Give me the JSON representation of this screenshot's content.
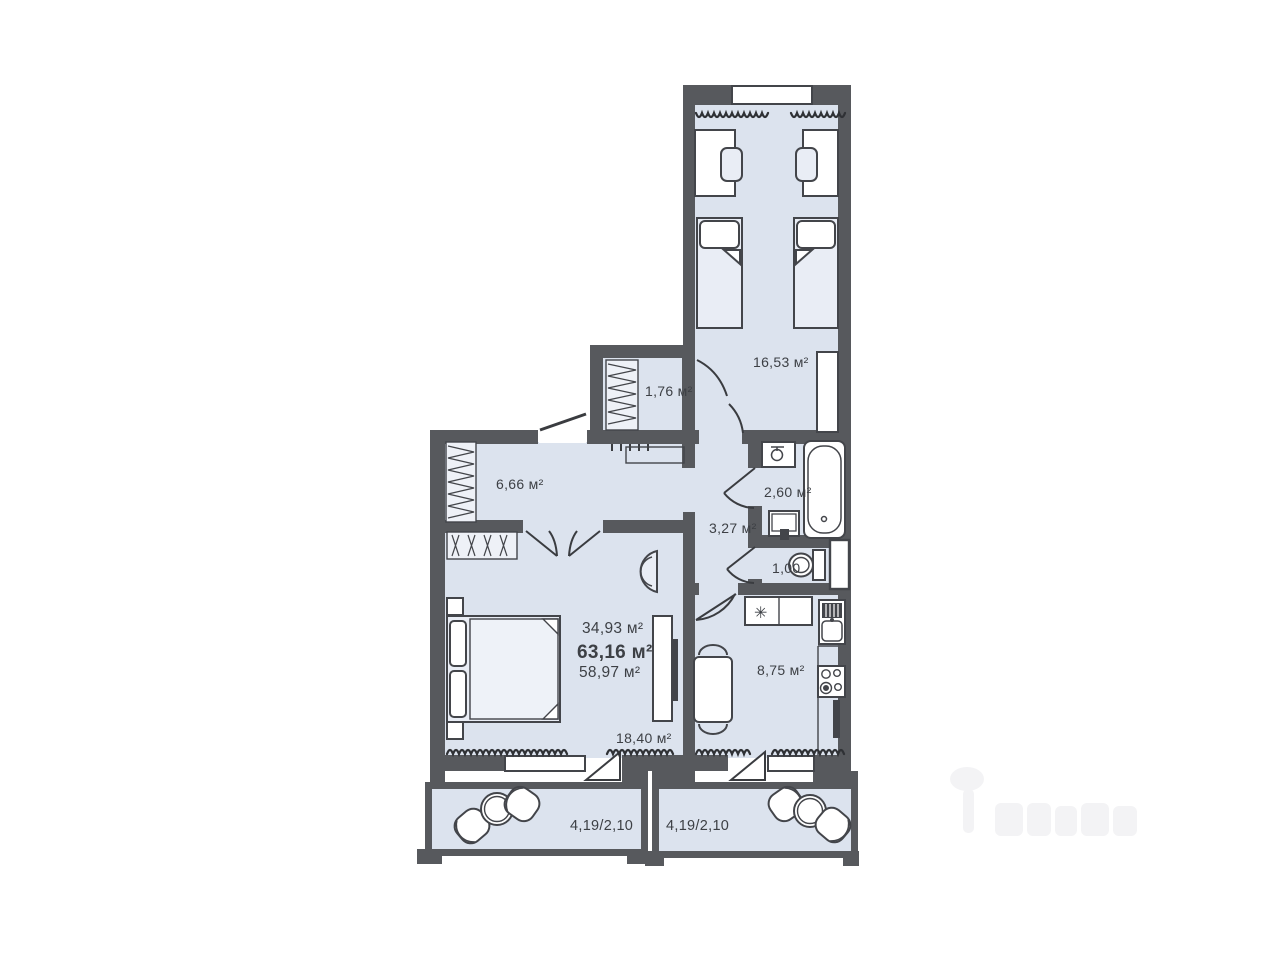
{
  "plan": {
    "summary": {
      "living_area": "34,93 м²",
      "total_area": "63,16 м²",
      "area_without_balconies": "58,97 м²"
    },
    "rooms": {
      "bedroom": "16,53 м²",
      "closet": "1,76 м²",
      "hallway": "6,66 м²",
      "bathroom": "2,60 м²",
      "corridor": "3,27 м²",
      "wc": "1,00",
      "kitchen": "8,75 м²",
      "living_room": "18,40 м²",
      "balcony_left": "4,19/2,10",
      "balcony_right": "4,19/2,10"
    },
    "icons": {
      "fridge_symbol": "✳"
    },
    "colors": {
      "wall": "#57595d",
      "floor": "#dce3ee",
      "outline": "#43454a",
      "furniture": "#e9edf5",
      "text": "#3d4045"
    }
  }
}
